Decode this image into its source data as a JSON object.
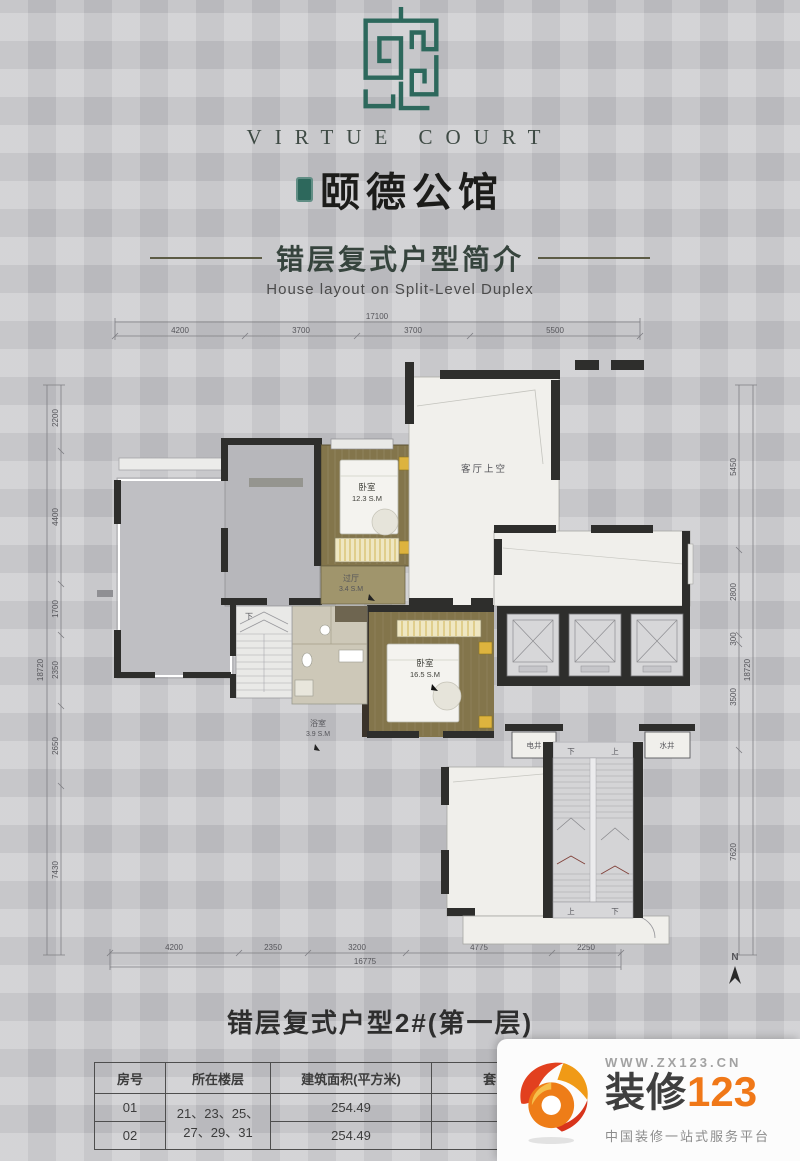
{
  "brand": {
    "name_en": "VIRTUE COURT",
    "name_cn": "颐德公馆"
  },
  "section": {
    "title_cn": "错层复式户型简介",
    "title_en": "House layout on Split-Level Duplex"
  },
  "floorplan": {
    "north": "N",
    "rooms": {
      "living_void": "客厅上空",
      "bedroom1_label": "卧室",
      "bedroom1_area": "12.3 S.M",
      "hall_label": "过厅",
      "hall_area": "3.4 S.M",
      "bedroom2_label": "卧室",
      "bedroom2_area": "16.5 S.M",
      "bath_label": "浴室",
      "bath_area": "3.9 S.M",
      "elec_shaft": "电井",
      "water_shaft": "水井"
    },
    "stairs": {
      "up": "上",
      "down": "下"
    },
    "dims": {
      "top": {
        "total": "17100",
        "segments": [
          "4200",
          "3700",
          "3700",
          "5500"
        ]
      },
      "bottom": {
        "total": "16775",
        "segments": [
          "4200",
          "2350",
          "3200",
          "4775",
          "2250"
        ]
      },
      "left": {
        "total": "18720",
        "segments": [
          "2200",
          "4400",
          "1700",
          "2350",
          "2650",
          "7430"
        ]
      },
      "right": {
        "total": "18720",
        "segments": [
          "5450",
          "2800",
          "300",
          "3500",
          "7620"
        ]
      }
    }
  },
  "plan_title": "错层复式户型2#(第一层)",
  "table": {
    "headers": [
      "房号",
      "所在楼层",
      "建筑面积(平方米)",
      "套内面积(平方米)"
    ],
    "floors": [
      "21、23、25、",
      "27、29、31"
    ],
    "rows": [
      {
        "no": "01",
        "build_area": "254.49",
        "inner_area": "201.61"
      },
      {
        "no": "02",
        "build_area": "254.49",
        "inner_area": "201.61"
      }
    ]
  },
  "watermark": {
    "url": "WWW.ZX123.CN",
    "brand_cn": "装修",
    "brand_num": "123",
    "tagline": "中国装修一站式服务平台"
  },
  "colors": {
    "brand_green": "#2d685c",
    "wall_black": "#2e2e2c",
    "wood_floor": "#83754b",
    "furniture_yellow": "#ddb33e",
    "watermark_orange": "#f07818"
  }
}
